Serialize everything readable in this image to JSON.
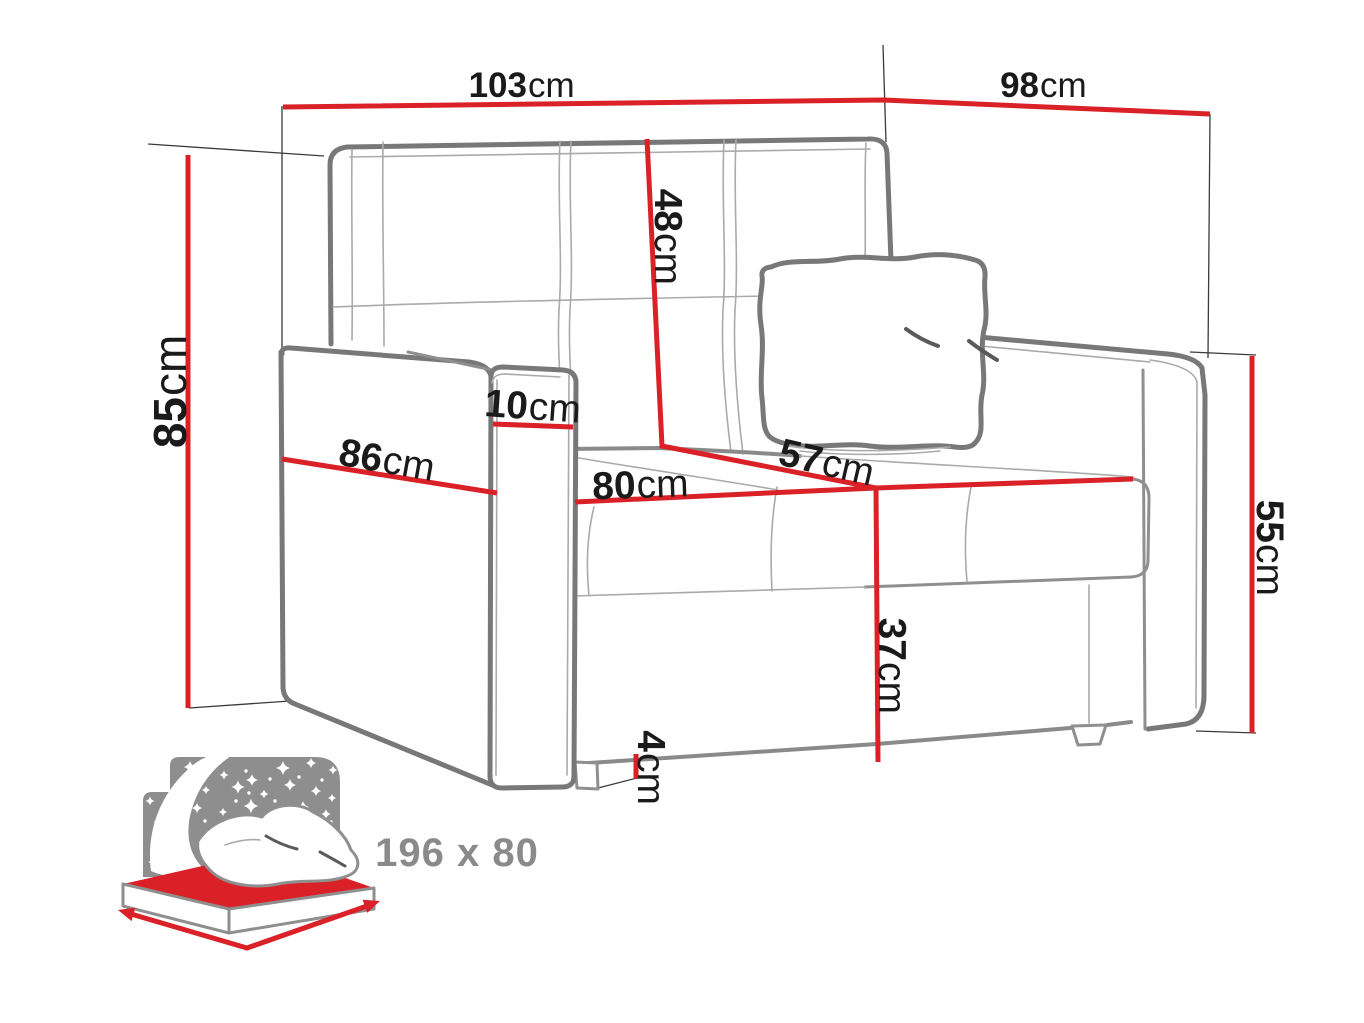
{
  "diagram": {
    "subject": "sofa-bed dimension diagram",
    "dimensions": {
      "overall_width": {
        "value": "103",
        "unit": "cm"
      },
      "overall_depth": {
        "value": "98",
        "unit": "cm"
      },
      "overall_height": {
        "value": "85",
        "unit": "cm"
      },
      "backrest_height": {
        "value": "48",
        "unit": "cm"
      },
      "armrest_width": {
        "value": "10",
        "unit": "cm"
      },
      "armrest_depth": {
        "value": "86",
        "unit": "cm"
      },
      "seat_width": {
        "value": "80",
        "unit": "cm"
      },
      "seat_depth": {
        "value": "57",
        "unit": "cm"
      },
      "armrest_height": {
        "value": "55",
        "unit": "cm"
      },
      "seat_height": {
        "value": "37",
        "unit": "cm"
      },
      "leg_height": {
        "value": "4",
        "unit": "cm"
      }
    },
    "sleeping_area": {
      "size_label": "196 x 80"
    },
    "colors": {
      "dimension_red": "#da2128",
      "outline_gray": "#787878",
      "seam_gray": "#aaaaaa",
      "icon_gray": "#8e8e8e",
      "icon_text_gray": "#8a8a8a",
      "label_color": "#1a1a1a"
    }
  }
}
